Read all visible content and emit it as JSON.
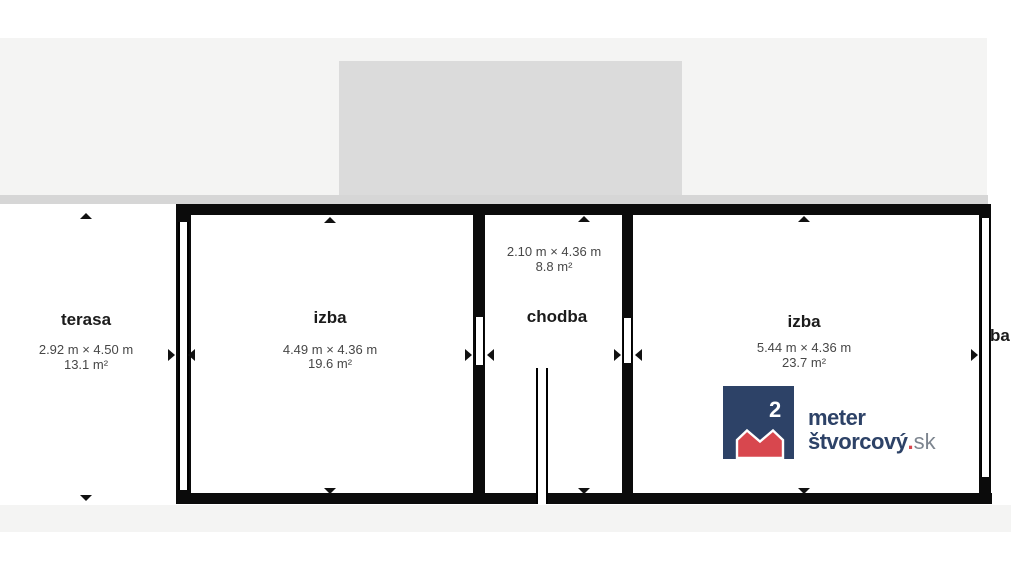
{
  "floorplan": {
    "rooms": {
      "terasa": {
        "label": "terasa",
        "dimensions": "2.92 m × 4.50 m",
        "area": "13.1 m²"
      },
      "izba1": {
        "label": "izba",
        "dimensions": "4.49 m × 4.36 m",
        "area": "19.6 m²"
      },
      "chodba": {
        "label": "chodba",
        "dimensions": "2.10 m × 4.36 m",
        "area": "8.8 m²"
      },
      "izba2": {
        "label": "izba",
        "dimensions": "5.44 m × 4.36 m",
        "area": "23.7 m²"
      },
      "clipped": {
        "label": "ba"
      }
    },
    "colors": {
      "wall": "#0b0b0b",
      "upper_floor_light": "#f4f4f3",
      "upper_floor_dark": "#dbdbdb",
      "edge_strip": "#d6d6d6"
    }
  },
  "logo": {
    "exponent": "2",
    "word1": "meter",
    "word2": "štvorcový",
    "dot": ".",
    "tld": "sk",
    "navy": "#2d4267",
    "red": "#d8474e",
    "tld_gray": "#7d858f"
  }
}
